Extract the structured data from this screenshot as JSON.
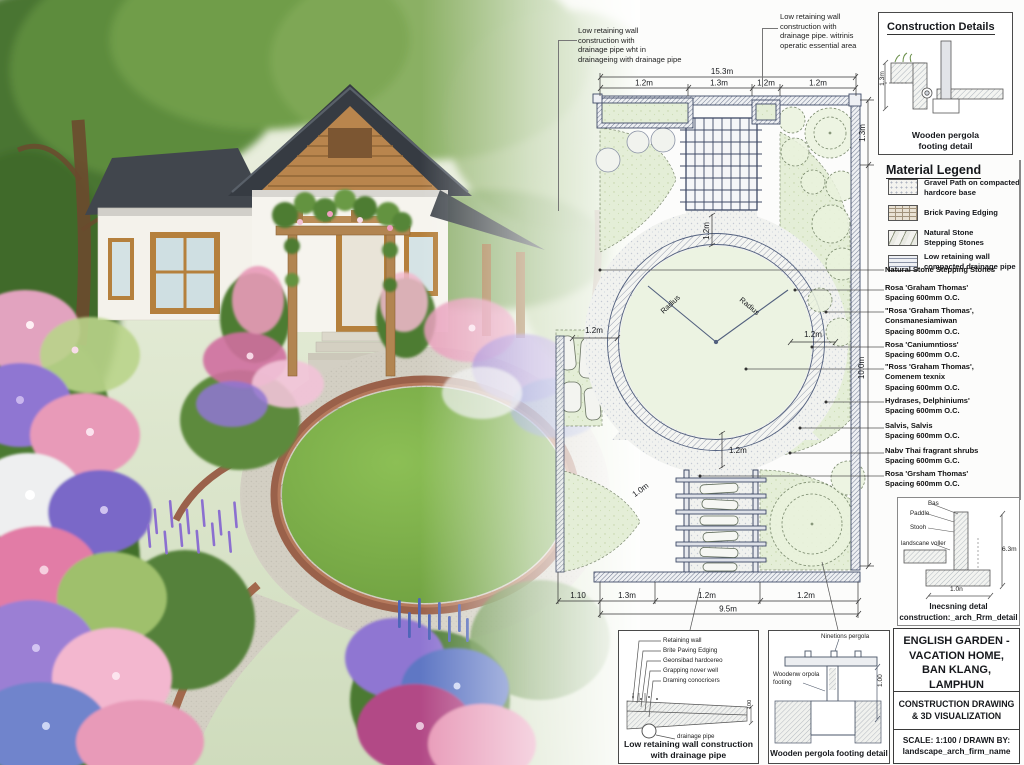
{
  "annotations": {
    "top_left": "Low retaining wall\nconstruction with\ndrainage pipe wht in\ndrainageing with drainage pipe",
    "top_middle": "Low retaining wall\nconstruction with\ndrainage pipe. witrinis\noperatic essential area"
  },
  "construction_details": {
    "title": "Construction Details",
    "dim": "1.3m",
    "caption": "Wooden pergola\nfooting detail"
  },
  "material_legend": {
    "title": "Material Legend",
    "items": [
      {
        "swatch": "gravel",
        "label": "Gravel Path on compacted\nhardcore base"
      },
      {
        "swatch": "brick",
        "label": "Brick Paving Edging"
      },
      {
        "swatch": "stone",
        "label": "Natural Stone\nStepping Stones"
      },
      {
        "swatch": "wall",
        "label": "Low retaining wall\ncompacted drainage pipe"
      }
    ],
    "callouts": [
      "Natural Stone Stepping Stones",
      "Rosa 'Graham Thomas'\nSpacing 600mm O.C.",
      "\"Rosa 'Graham Thomas',\nConsmanesiamiwan\nSpacing 800mm O.C.",
      "Rosa 'Caniumntioss'\nSpacing 600mm O.C.",
      "\"Ross 'Graham Thomas',\nComenem texnix\nSpacing 600mm O.C.",
      "Hydrases, Delphiniums'\nSpacing 600mm O.C.",
      "Salvis, Salvis\nSpacing 600mm O.C.",
      "Nabv Thai fragrant shrubs\nSpacing 600mm G.C.",
      "Rosa 'Grsham Thomas'\nSpacing 600mm O.C."
    ]
  },
  "plan": {
    "dims": {
      "top_overall": "15.3m",
      "top_segments": [
        "1.2m",
        "1.3m",
        "1.2m",
        "1.2m"
      ],
      "right_upper": "1.3m",
      "right_side": "10.0m",
      "pergola_gap": "1.2m",
      "bed_gap_left": "1.2m",
      "bed_gap_right": "1.2m",
      "circle_gap": "1.2m",
      "path_width": "1.0m",
      "radius_label": "Radius",
      "bottom_segments": [
        "1.10",
        "1.3m",
        "1.2m",
        "1.2m"
      ],
      "bottom_overall": "9.5m"
    }
  },
  "detail_wall": {
    "labels": [
      "Retaining wall",
      "Brite Paving Edging",
      "Geonsibad hardcereo",
      "Grapping nover well",
      "Draming conocricers"
    ],
    "pipe_label": "drainage pipe",
    "dim": "100",
    "caption": "Low retaining wall construction\nwith drainage pipe"
  },
  "detail_pergola": {
    "top_label": "Ninetions pergola",
    "left_label": "Woodenw orpola\nfooting",
    "dim": "1.00",
    "caption": "Wooden pergola footing detail"
  },
  "detail_side": {
    "labels": [
      "Bas",
      "Paddle",
      "Stooh",
      "landscane voller"
    ],
    "dim_right": "6.3m",
    "dim_bottom": "1.0n",
    "caption": "Inecsning detal\nconstruction:_arch_Rrm_detail"
  },
  "title_block": {
    "project": "ENGLISH GARDEN -\nVACATION HOME,\nBAN KLANG, LAMPHUN",
    "drawing": "CONSTRUCTION DRAWING\n& 3D VISUALIZATION",
    "scale": "SCALE: 1:100 / DRAWN BY:\nlandscape_arch_firm_name"
  },
  "colors": {
    "plan_line": "#45506b",
    "plan_green": "#e3eed6",
    "gravel_stipple": "#f1f2f0",
    "lawn_green": "#7fae4e",
    "roof": "#383d44",
    "wood": "#b28551",
    "flower_pink": "#e89ab8",
    "flower_purple": "#8f76d2",
    "flower_blue": "#5f77c4",
    "paper": "#fcfcfb"
  }
}
